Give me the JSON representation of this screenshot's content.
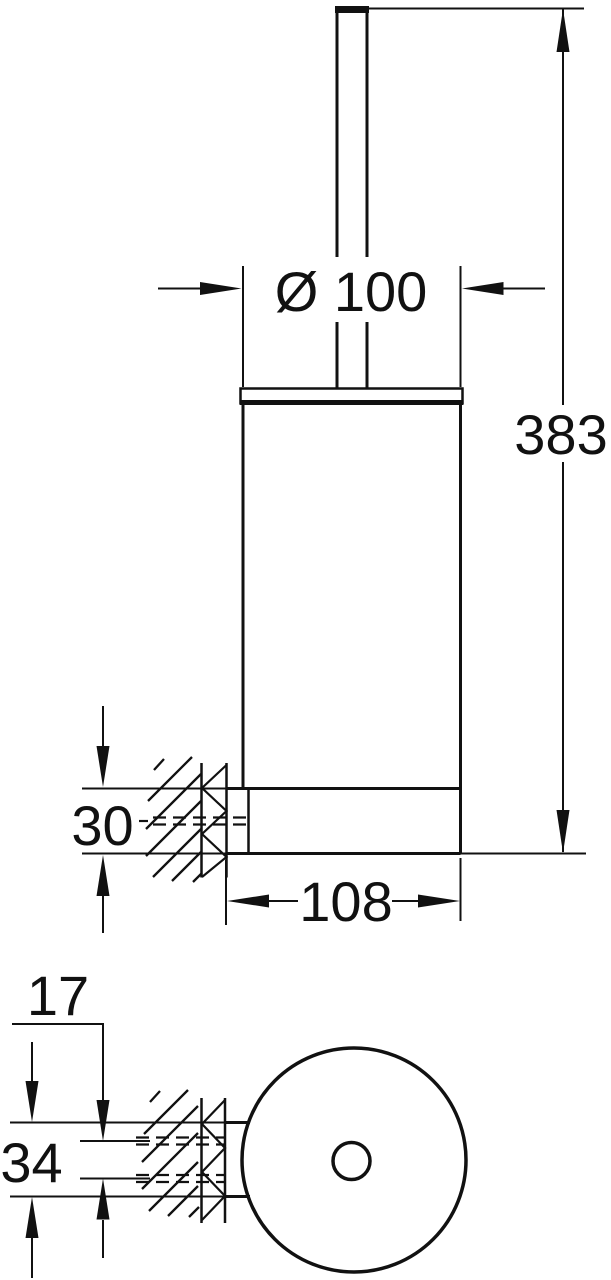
{
  "drawing": {
    "type": "technical-dimension-drawing",
    "background_color": "#ffffff",
    "line_color": "#111111",
    "front_view": {
      "dim_diameter": "Ø 100",
      "dim_overall_height": "383",
      "dim_holder_bracket_height": "30",
      "dim_base_depth": "108"
    },
    "bottom_view": {
      "dim_screw_spacing": "17",
      "dim_plate_height": "34"
    }
  }
}
